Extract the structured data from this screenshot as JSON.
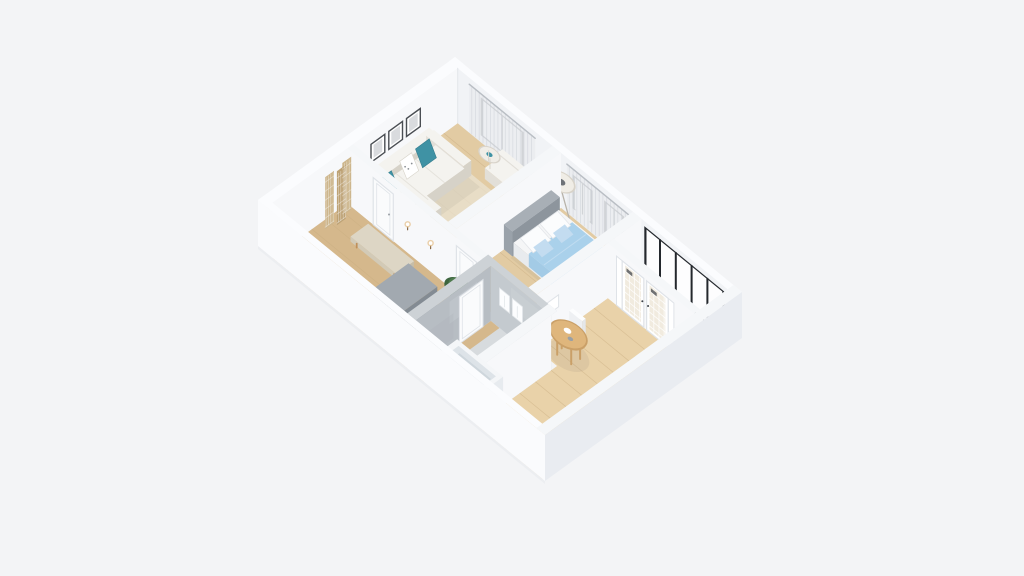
{
  "view": {
    "kind": "isometric-3d-floorplan-render",
    "width": 1024,
    "height": 576
  },
  "colors": {
    "bg": "#f3f4f6",
    "wall_top": "#f5f7f9",
    "wall_top_bright": "#fbfcfe",
    "wall_face": "#f7f8fa",
    "wall_inner_back": "#f1f3f6",
    "outer_sw": "#fafbfd",
    "outer_se": "#e9ecf1",
    "base_shadow": "#dfe3e8",
    "corner_line": "#e3e6ea",
    "floor_wood": "#e2cba3",
    "floor_wood_dark": "#d5b88c",
    "floor_dining": "#e9d2a9",
    "plank_line": "#c6a97c",
    "floor_balcony": "#efedea",
    "bath_floor": "#d7dbde",
    "bath_wall": "#b7bdc3",
    "bath_wall_2": "#c4cacf",
    "bath_wall_top": "#cdd2d6",
    "tub_white": "#f4f6f8",
    "tub_inner": "#dde3e8",
    "tub_deep": "#ced6dc",
    "tub_front": "#eef1f4",
    "tub_side": "#e7ebef",
    "window_frame": "#24282d",
    "glass": "#fdfdfe",
    "curtain": "#e9ecef",
    "curtain_stripe": "#c7ccd3",
    "rod": "#b9bec4",
    "sofa": "#f4f3ef",
    "sofa_shade": "#e2dfd8",
    "sofa_dark": "#d6d2c8",
    "teal": "#3f92a4",
    "teal_dark": "#347d8e",
    "rug": "#eae3d2",
    "bed_blue": "#aad1eb",
    "bed_blue_shade": "#9bc5e1",
    "bed_blue_side": "#a3cbe6",
    "blanket_fold": "#c2ddf1",
    "headboard_top": "#a8afb6",
    "headboard": "#9aa2aa",
    "headboard_side": "#8d959d",
    "mattress": "#f5f6f7",
    "mattress_side": "#e8ebee",
    "pillow": "#fbfcfd",
    "pillow_blue": "#c3dcf0",
    "white": "#fcfdfe",
    "door_white": "#fafbfc",
    "door_line": "#dfe3e8",
    "handle": "#9aa0a6",
    "handle_dark": "#3c4045",
    "wood": "#c0905a",
    "table_top": "#dfb67c",
    "table_side": "#caa068",
    "bench": "#ddd6c5",
    "bench_front": "#d2cab7",
    "bench_side": "#c6bda8",
    "wardrobe_top": "#a2a9b0",
    "wardrobe": "#949ca4",
    "wardrobe_side": "#838b93",
    "wardrobe_seam": "#7e868e",
    "plant": "#4e7a4e",
    "plant_dark": "#3d653e",
    "plant_light": "#6b9560",
    "pot": "#24282c",
    "pot_side": "#1a1d21",
    "pot_top": "#2e3236",
    "screen_panel": "#cdb68d",
    "screen_shade": "#bda275",
    "frame_dark": "#4a4e53",
    "art_gray": "#b9bec3",
    "art_mark": "#43474c",
    "sconce_glow": "#e8c89a",
    "sconce_stem": "#8a6b4a",
    "french_glass": "#f1ebdf",
    "radiator": "#fafbfc",
    "towel": "#fcfdfe",
    "towel_line": "#e3e7ea",
    "lamp_shade": "#f0ede6",
    "lamp_rim": "#d8d3c9",
    "lamp_leg": "#b8b3aa",
    "lamp_core": "#6e7277",
    "side_table": "#f0ede7",
    "side_table_rim": "#d9d4cb",
    "shadow": "#1c2430"
  },
  "scene": {
    "rooms": [
      {
        "name": "living-room",
        "floor": "wood"
      },
      {
        "name": "bedroom",
        "floor": "wood"
      },
      {
        "name": "dining-room",
        "floor": "wood"
      },
      {
        "name": "balcony",
        "floor": "light"
      },
      {
        "name": "hallway",
        "floor": "wood"
      },
      {
        "name": "bathroom",
        "floor": "gray-concrete"
      }
    ],
    "furniture": [
      "corner-sofa",
      "teal-pillows",
      "wall-art-frames",
      "folding-screen",
      "armchair",
      "side-table",
      "area-rug",
      "double-bed",
      "gray-headboard",
      "blue-bedding",
      "white-pillows",
      "floor-lamp",
      "wall-sconces",
      "interior-doors",
      "hall-bench",
      "gray-wardrobe",
      "potted-plant",
      "bathtub",
      "hanging-towels",
      "bathroom-door",
      "round-dining-table",
      "dining-chair",
      "french-doors",
      "panorama-window-band",
      "framed-windows",
      "sheer-curtains",
      "radiators"
    ]
  }
}
